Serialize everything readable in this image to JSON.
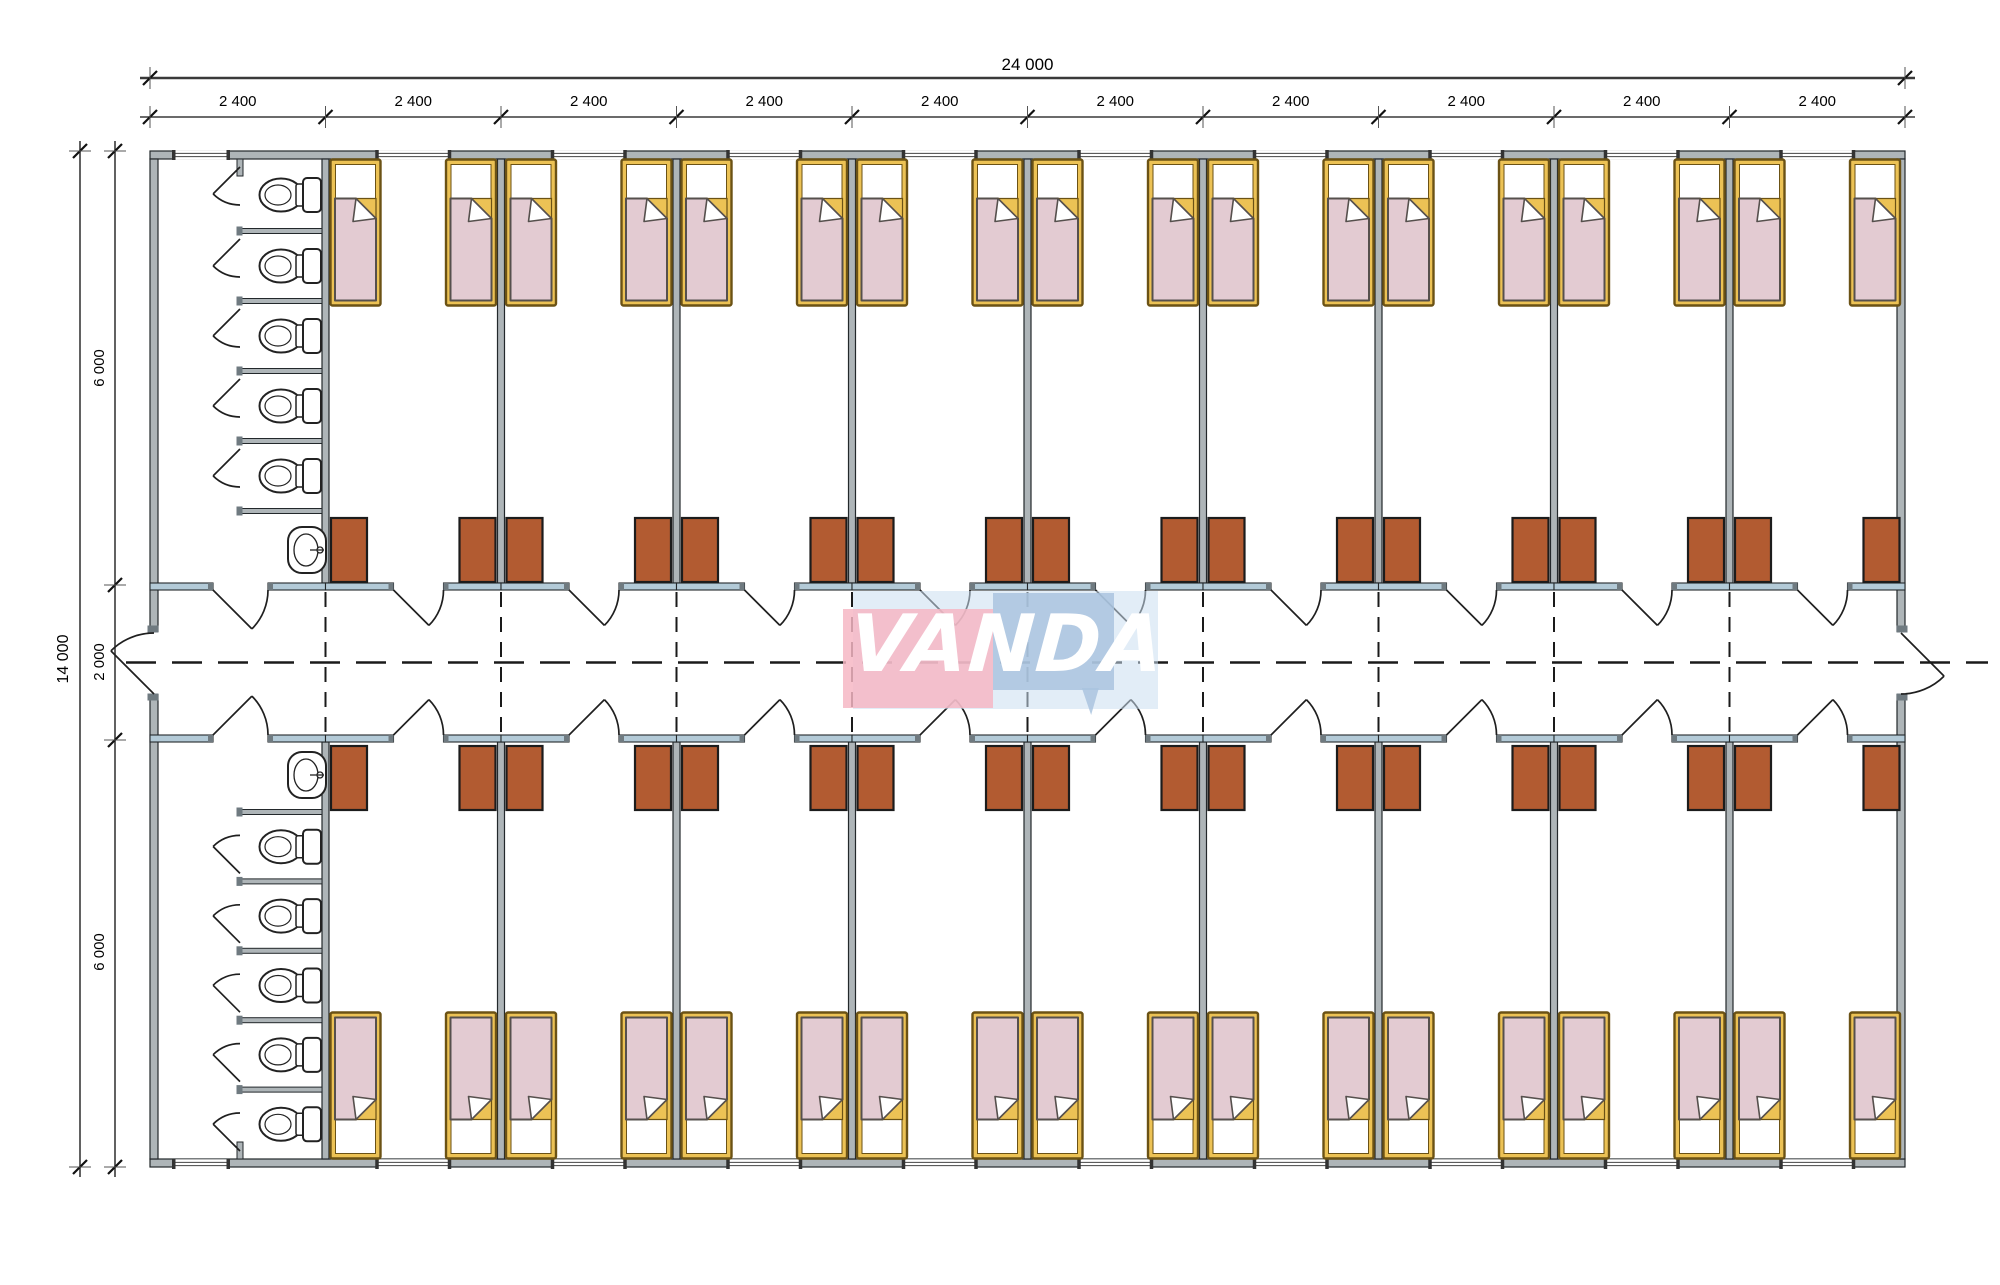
{
  "document": {
    "type": "dormitory-container-floor-plan",
    "units": "mm"
  },
  "dimensions": {
    "overall_width": "24 000",
    "overall_height": "14 000",
    "bay_width": "2 400",
    "bay_count": 10,
    "top_wing_depth": "6 000",
    "corridor_width": "2 000",
    "bottom_wing_depth": "6 000"
  },
  "watermark": {
    "text": "VANDA"
  },
  "rooms": {
    "per_row": 9,
    "rows": 2,
    "beds_per_room": 2,
    "wardrobes_per_room": 2,
    "beds_total": 36,
    "wardrobes_total": 36
  },
  "sanitary": {
    "blocks": 2,
    "toilet_stalls_per_block": 5,
    "sinks_per_block": 1
  },
  "icons": [
    "bed-icon",
    "wardrobe-icon",
    "toilet-icon",
    "sink-icon",
    "door-swing-icon",
    "window-icon",
    "centerline-icon",
    "dimension-tick-icon"
  ],
  "colors": {
    "wall_fill": "#aeb5b8",
    "corridor_wall_fill": "#b3cad7",
    "wall_cap": "#6f7a80",
    "outline": "#23282b",
    "bed_frame": "#ecc255",
    "bed_frame_outline": "#6b5215",
    "blanket": "#e3cbd2",
    "blanket_outline": "#56504d",
    "wardrobe": "#b25b31",
    "wardrobe_outline": "#1c1c1c",
    "fixture_outline": "#222222",
    "dim_line": "#3a3a3a",
    "text": "#000000",
    "centerline": "#1a1a1a",
    "watermark_pink": "#f5b6c3",
    "watermark_blue": "#a9c3df",
    "watermark_shadow": "#cbdff0",
    "watermark_text": "#ffffff"
  }
}
